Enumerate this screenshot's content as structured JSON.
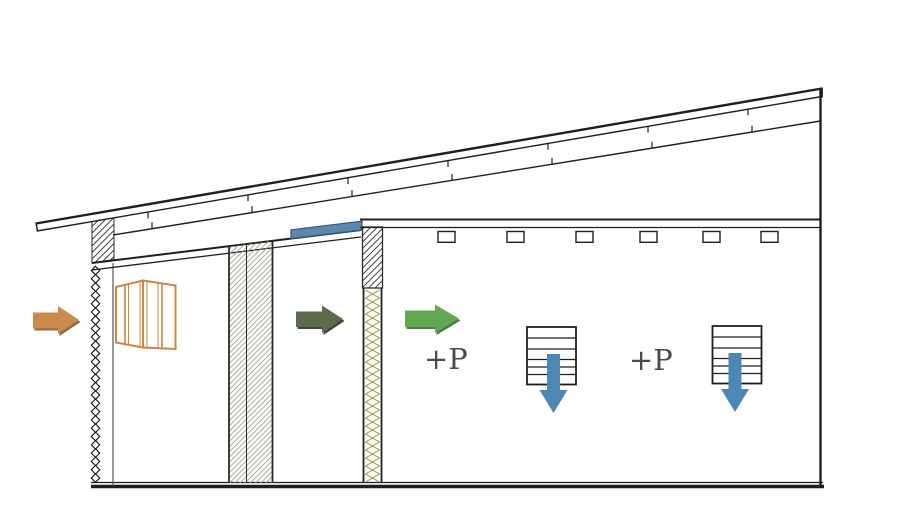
{
  "labels": {
    "pressure_zone_1": "+P",
    "pressure_zone_2": "+P"
  },
  "colors": {
    "line_dark": "#1f1f1f",
    "label_text": "#4a4a4a",
    "outdoor_air_arrow": "#c98a4c",
    "outdoor_air_arrow_shade": "#8f6a45",
    "cavity_air_arrow": "#5c6b4d",
    "cavity_air_arrow_shade": "#3d4836",
    "supply_air_arrow": "#62a854",
    "supply_air_arrow_shade": "#4a7f3f",
    "down_flow_arrow": "#4d87b4",
    "vent_band": "#5c88ae",
    "vent_band_edge": "#35597a",
    "insulation_zigzag": "#ad9d57",
    "wall_hatch_green": "#97a089",
    "window_frame": "#cc863d"
  },
  "counts": {
    "roof_purlin_joints": 7,
    "ceiling_joist_boxes": 6,
    "ceiling_diffusers": 2,
    "mesh_links": 26
  }
}
